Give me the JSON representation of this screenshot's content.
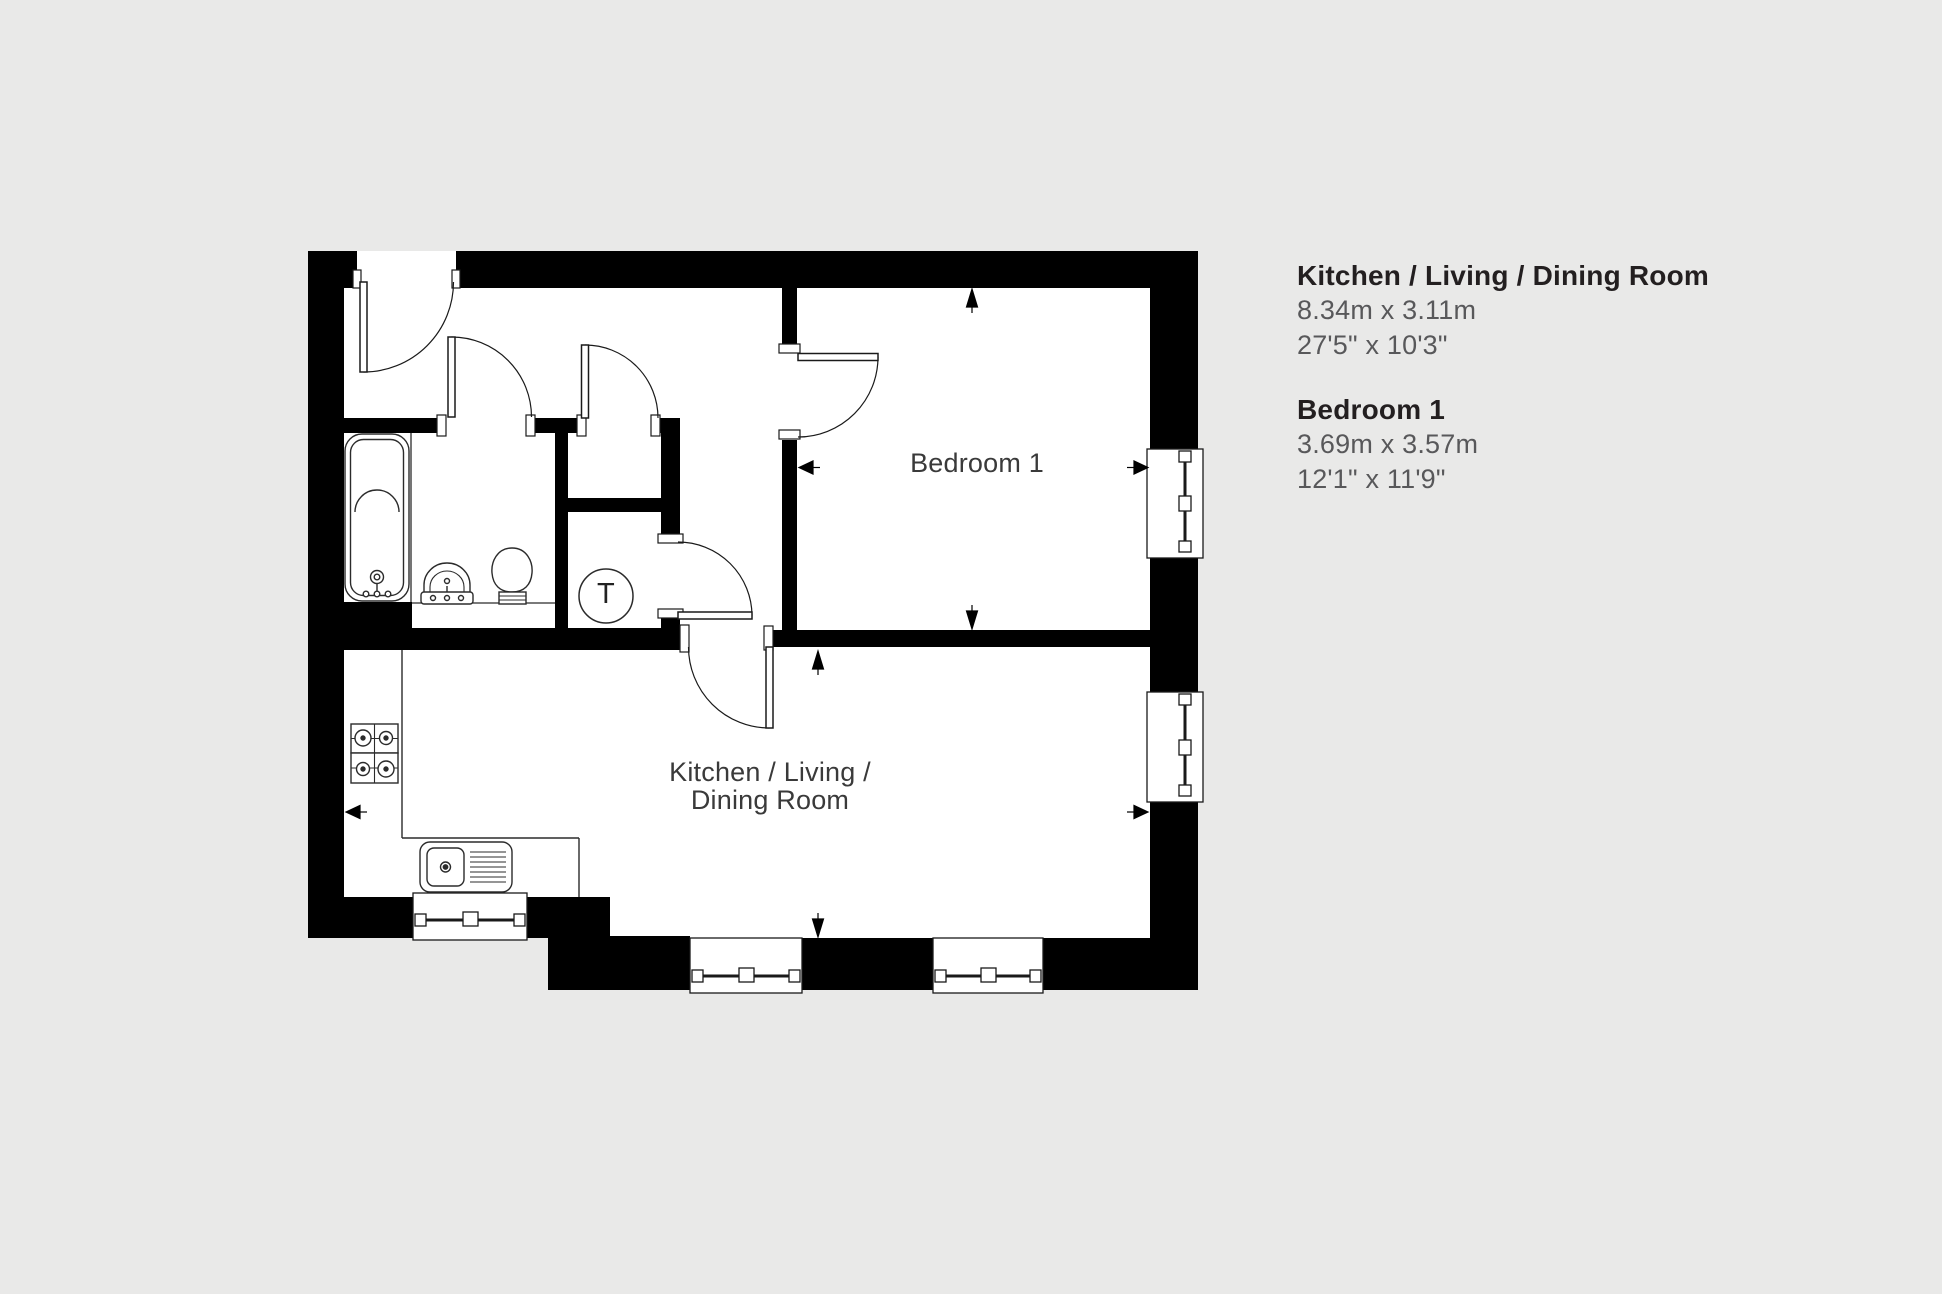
{
  "colors": {
    "background": "#e9e9e8",
    "floor": "#ffffff",
    "walls": "#000000",
    "panel_title_text": "#231f20",
    "panel_dim_text": "#58585a",
    "plan_label_text": "#3a3a3a"
  },
  "side_panel": {
    "rooms": [
      {
        "name": "Kitchen / Living / Dining Room",
        "metric": "8.34m x 3.11m",
        "imperial": "27'5\" x 10'3\""
      },
      {
        "name": "Bedroom 1",
        "metric": "3.69m x 3.57m",
        "imperial": "12'1\" x 11'9\""
      }
    ]
  },
  "plan": {
    "labels": {
      "bedroom": "Bedroom 1",
      "kitchen_line1": "Kitchen / Living /",
      "kitchen_line2": "Dining Room",
      "tank": "T"
    }
  }
}
